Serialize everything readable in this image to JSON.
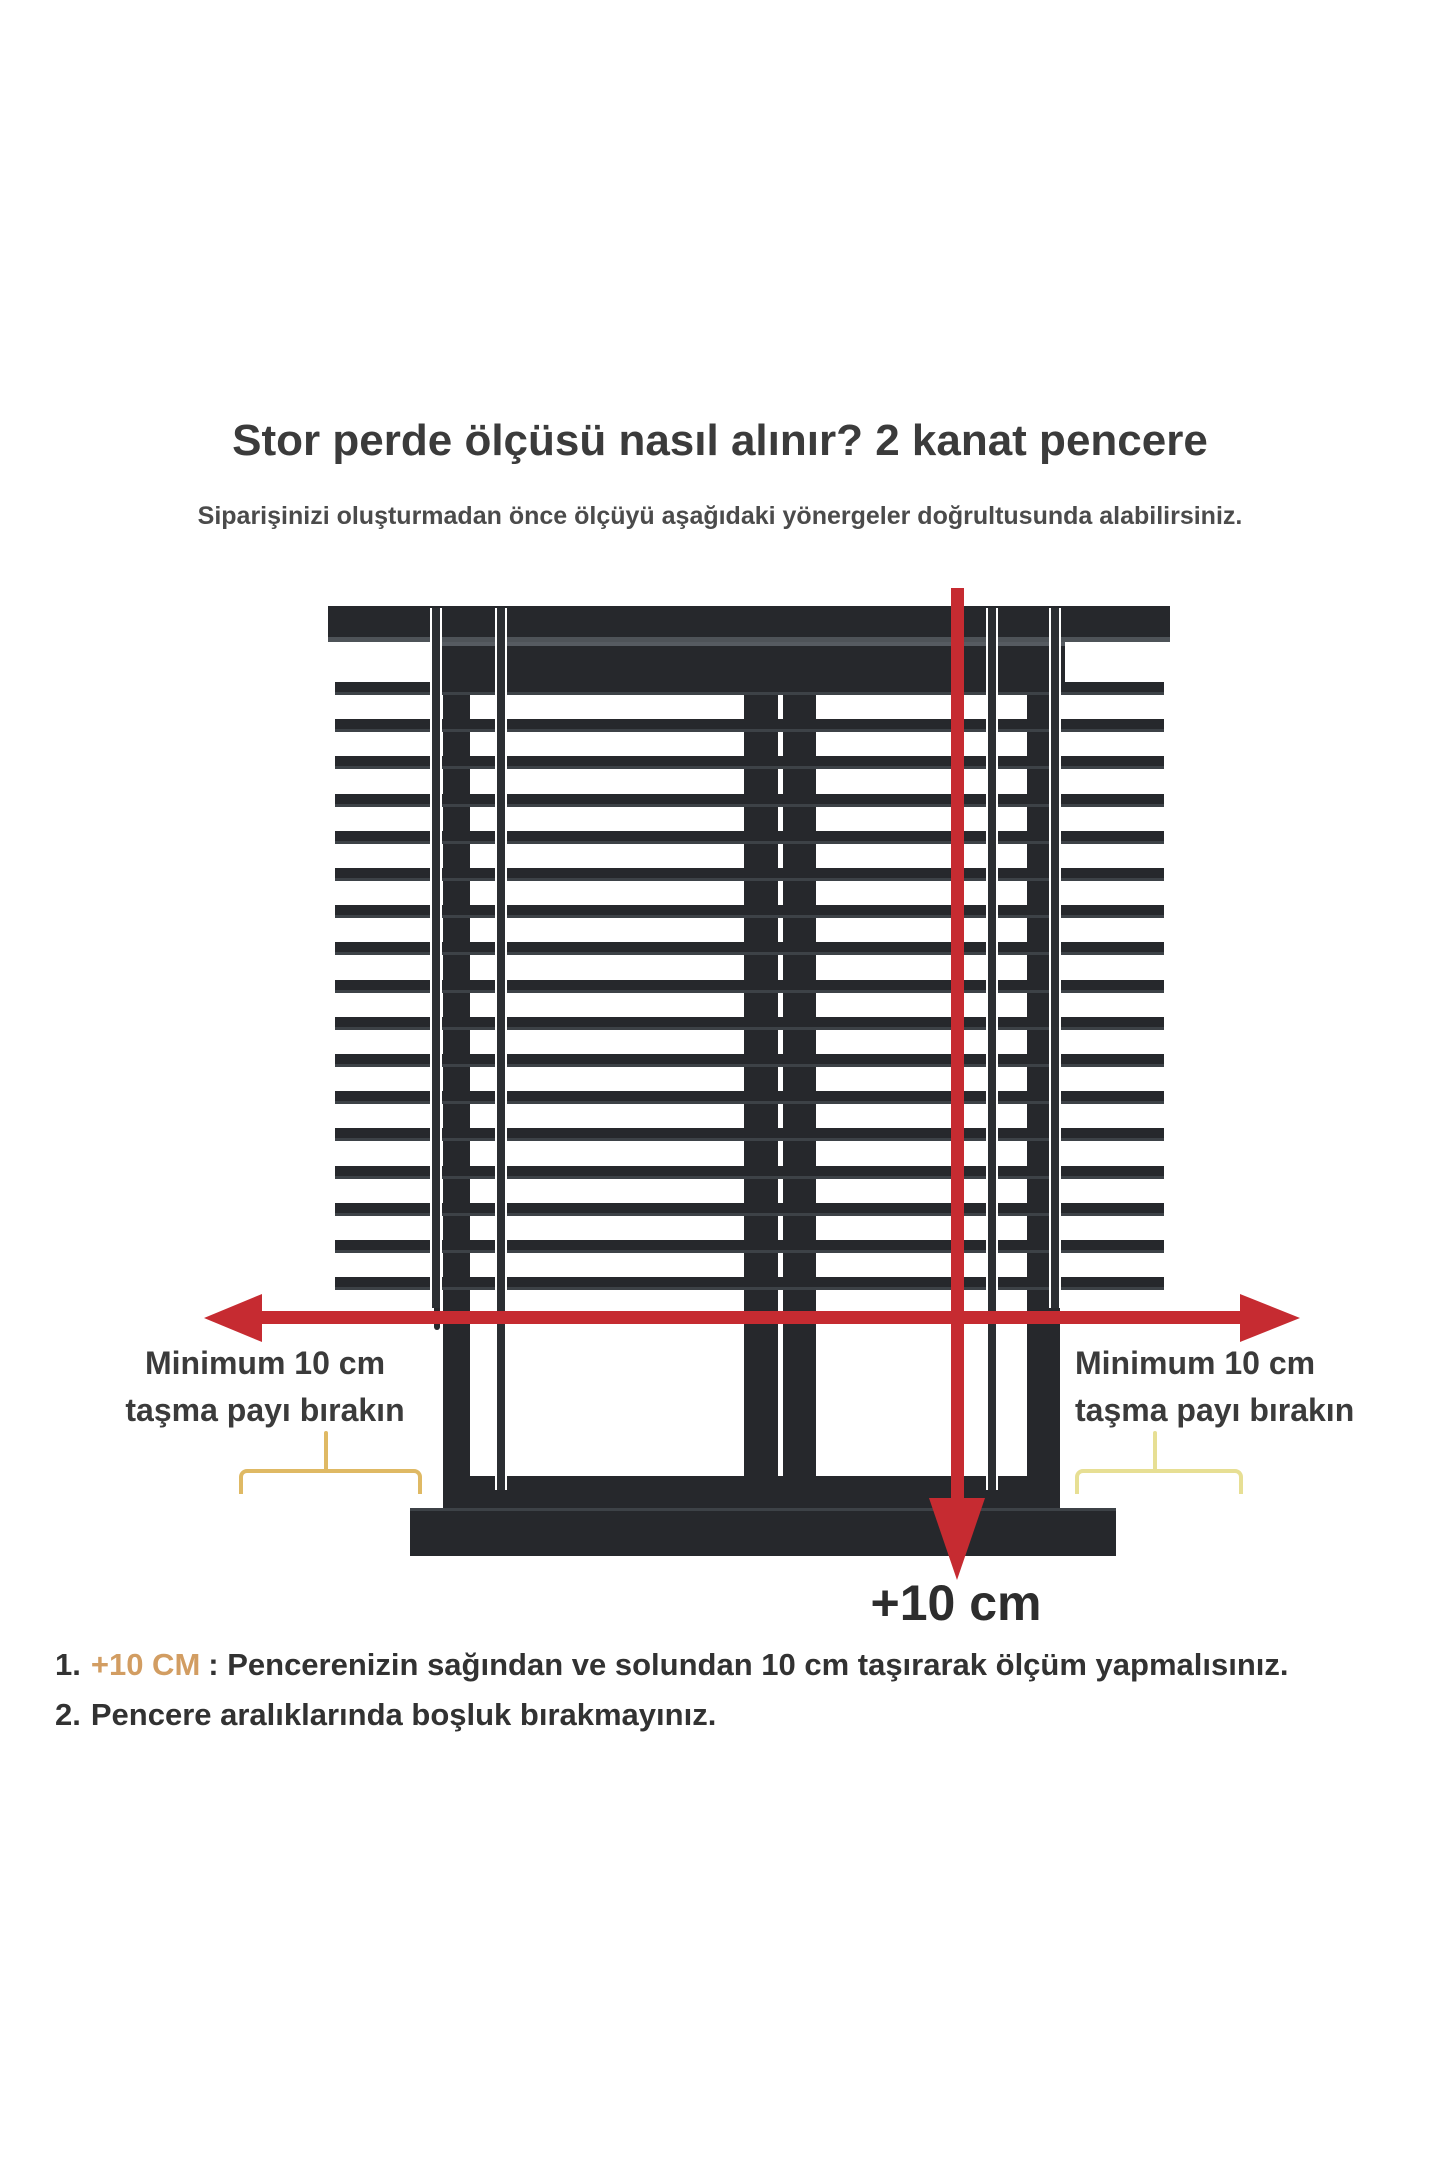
{
  "title": "Stor perde ölçüsü nasıl alınır? 2 kanat pencere",
  "subtitle": "Siparişinizi oluşturmadan önce ölçüyü aşağıdaki yönergeler doğrultusunda alabilirsiniz.",
  "labels": {
    "left": {
      "line1": "Minimum 10 cm",
      "line2": "taşma payı bırakın"
    },
    "right": {
      "line1": "Minimum 10 cm",
      "line2": "taşma payı bırakın"
    },
    "plus10": "+10 cm"
  },
  "instructions": [
    {
      "prefix": "1.",
      "highlight": "+10 CM",
      "text": ": Pencerenizin sağından ve solundan 10 cm taşırarak ölçüm yapmalısınız."
    },
    {
      "prefix": "2.",
      "highlight": "",
      "text": "Pencere aralıklarında boşluk bırakmayınız."
    }
  ],
  "diagram": {
    "slat_count": 17,
    "slat_top_start": 682,
    "slat_pitch": 37.2
  },
  "colors": {
    "arrow_red": "#c62b31",
    "blind_dark": "#26282c",
    "brace_left": "#dfb964",
    "brace_right": "#e7df94",
    "highlight_orange": "#d29d62"
  }
}
